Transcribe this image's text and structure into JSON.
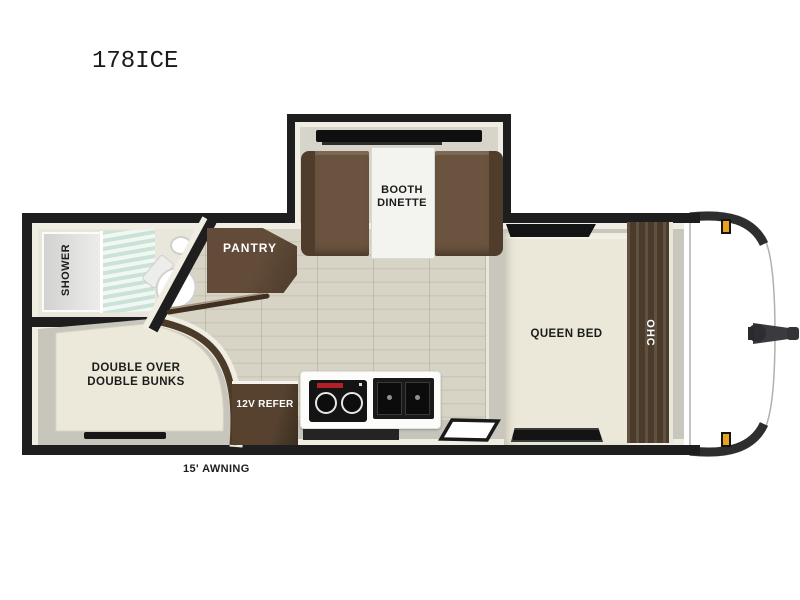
{
  "title": "178ICE",
  "labels": {
    "booth_dinette": "BOOTH\nDINETTE",
    "pantry": "PANTRY",
    "shower": "SHOWER",
    "queen_bed": "QUEEN BED",
    "ohc": "OHC",
    "bunks": "DOUBLE OVER\nDOUBLE BUNKS",
    "refer": "12V REFER",
    "awning": "15' AWNING"
  },
  "colors": {
    "wall": "#1e1e1e",
    "trim": "#f0ede2",
    "wood_floor": "#d6d2c4",
    "gray_floor": "#c9c6bd",
    "furniture_brown": "#5d4936",
    "mattress": "#ece9da",
    "window": "#141414",
    "shower_glass": "#cde4d8",
    "marker_light_amber": "#e8a31c",
    "cooktop_label_red": "#b32025"
  }
}
